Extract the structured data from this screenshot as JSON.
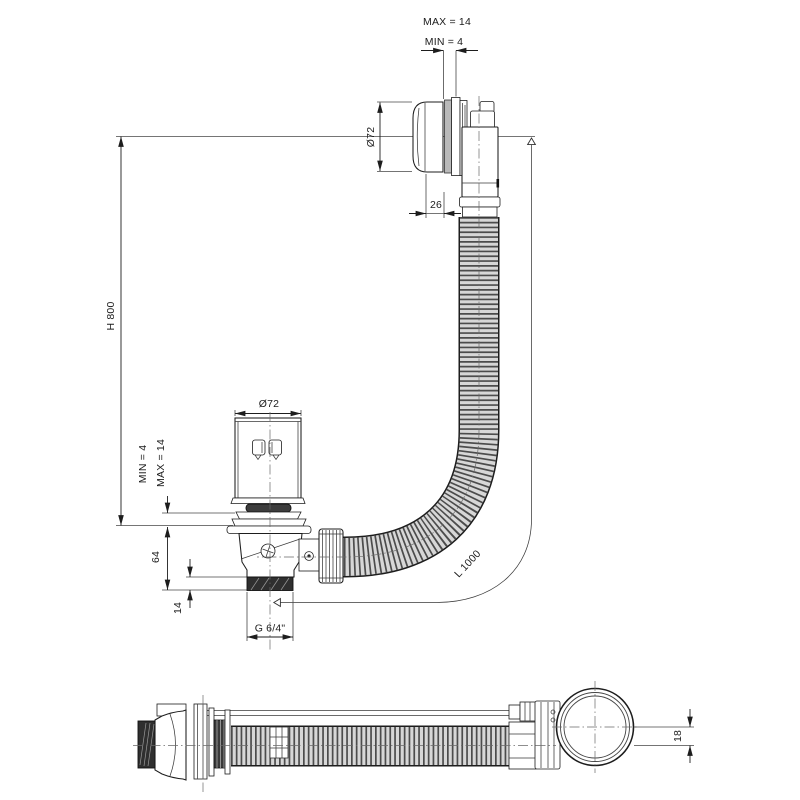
{
  "dimensions": {
    "overflow": {
      "max_gap": "MAX = 14",
      "min_gap": "MIN = 4",
      "diameter": "Ø72",
      "cap_depth": "26"
    },
    "installation_height": "H 800",
    "waste": {
      "min_gap": "MIN = 4",
      "max_gap": "MAX = 14",
      "diameter": "Ø72",
      "body_height": "64",
      "thread_length": "14",
      "thread_size": "G 6/4\""
    },
    "hose_length": "L 1000",
    "side_view": {
      "axis_offset": "18"
    }
  },
  "colors": {
    "line": "#1d1d1d",
    "hose_fill": "#d7d7d7",
    "hose_rib": "#4c4c4c",
    "dark_fill": "#2f2f2f",
    "background": "#ffffff"
  }
}
